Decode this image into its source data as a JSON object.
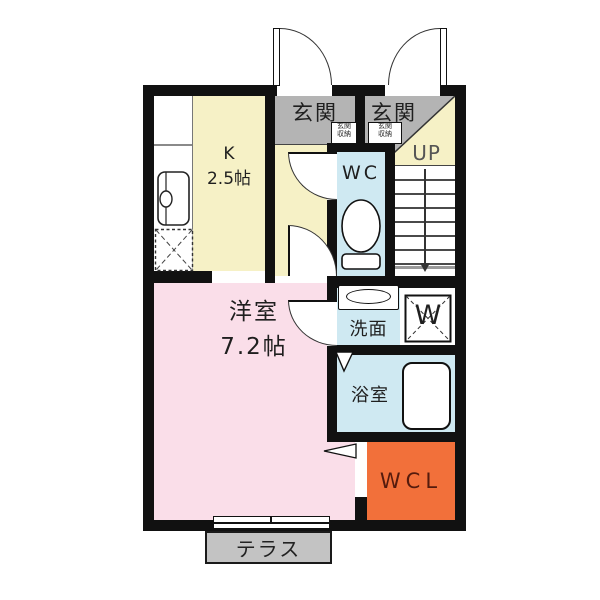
{
  "colors": {
    "wall": "#111111",
    "kitchen_floor": "#f6f1c6",
    "entrance_floor": "#b4b4b4",
    "wet_floor": "#cfe9f2",
    "room_floor": "#fadee9",
    "closet_floor": "#f2703a",
    "terrace_floor": "#c3c3c3",
    "text": "#1f1f1f",
    "closet_text": "#551b0d",
    "up_text": "#555555"
  },
  "labels": {
    "entrance_left": "玄関",
    "entrance_right": "玄関",
    "entrance_storage_line1": "玄関",
    "entrance_storage_line2": "収納",
    "kitchen_line1": "K",
    "kitchen_line2": "2.5帖",
    "wc": "WC",
    "stairs_up": "UP",
    "washroom": "洗面",
    "washer": "W",
    "bathroom": "浴室",
    "western_room_line1": "洋室",
    "western_room_line2": "7.2帖",
    "closet": "WCL",
    "terrace": "テラス"
  }
}
